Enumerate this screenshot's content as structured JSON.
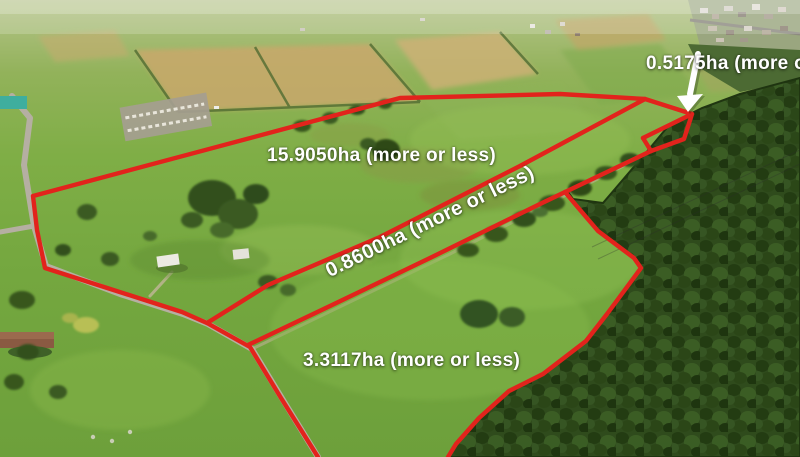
{
  "overlay": {
    "colors": {
      "boundary_red": "#e2231c",
      "label_white": "#ffffff",
      "arrow_white": "#ffffff"
    },
    "parcels": [
      {
        "name": "parcel-15-9050ha",
        "label": "15.9050ha (more or less)"
      },
      {
        "name": "parcel-0-8600ha",
        "label": "0.8600ha (more or less)"
      },
      {
        "name": "parcel-3-3117ha",
        "label": "3.3117ha (more or less)"
      },
      {
        "name": "parcel-0-5175ha",
        "label": "0.5175ha (more or less)"
      }
    ],
    "arrow_points_to": "parcel-0-5175ha"
  }
}
